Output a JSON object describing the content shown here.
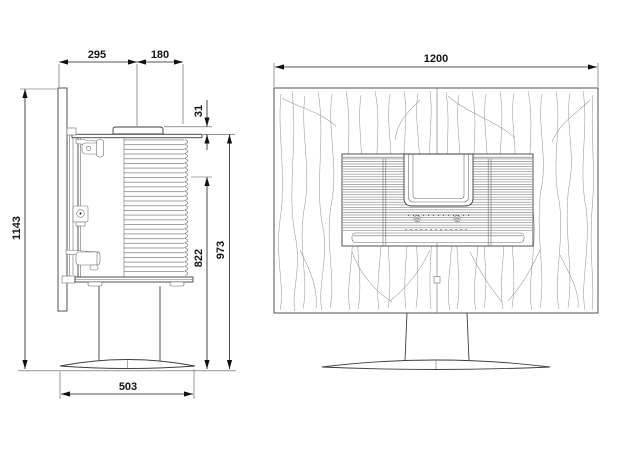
{
  "side_view": {
    "back_depth": "295",
    "body_depth": "180",
    "top_clearance": "31",
    "total_height": "1143",
    "door_height": "822",
    "top_height": "973",
    "base_width": "503"
  },
  "front_view": {
    "panel_width": "1200"
  }
}
